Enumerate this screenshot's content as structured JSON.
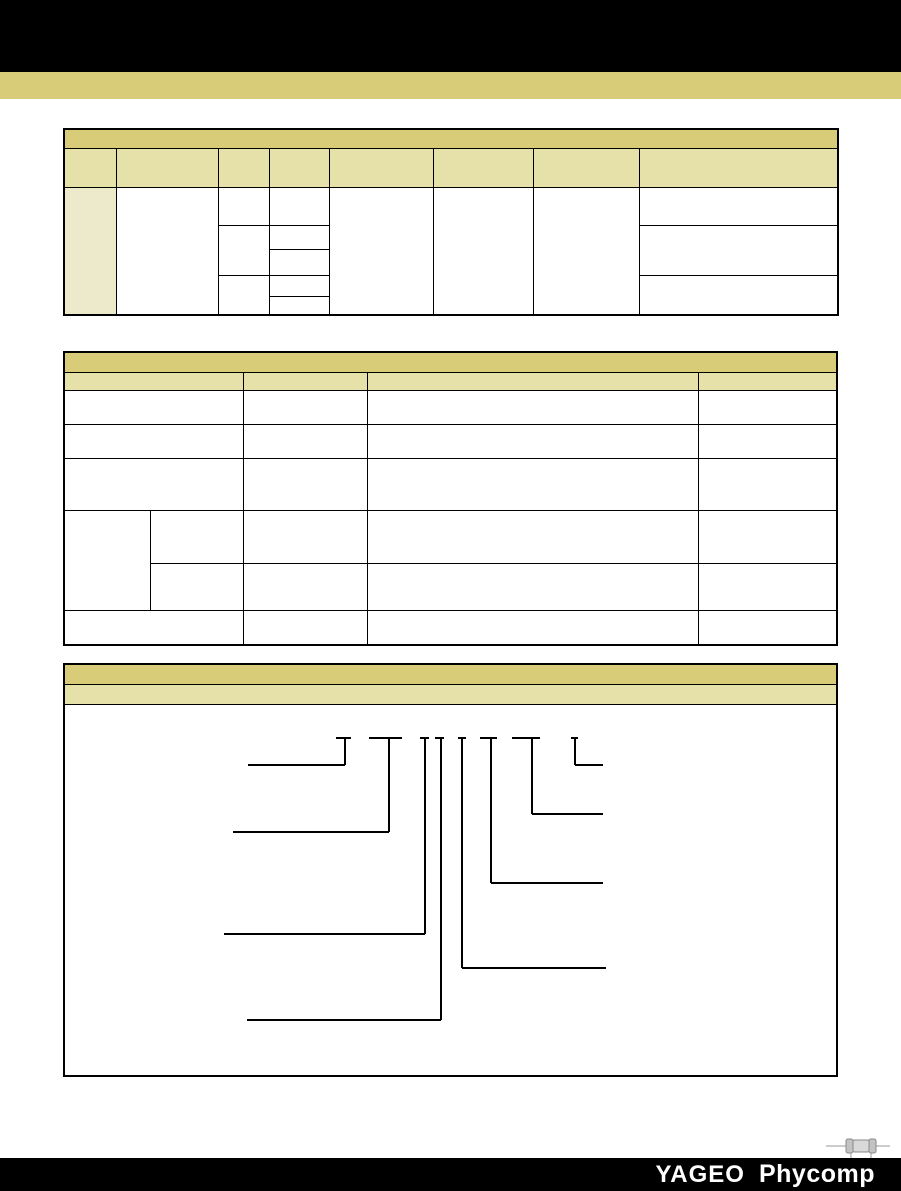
{
  "colors": {
    "black_band": "#000000",
    "khaki_band": "#d8cc79",
    "title_bar_bg": "#d8cc79",
    "header_row_bg": "#e6e0a9",
    "shaded_cell_bg": "#ede9cb",
    "table_border": "#000000",
    "diagram_line": "#000000",
    "footer_bg": "#000000",
    "footer_text": "#ffffff",
    "icon_gray": "#999999"
  },
  "sections": {
    "table1": {
      "title_text": ""
    },
    "table2": {
      "title_text": ""
    },
    "ordering": {
      "title_text": "",
      "subtitle_text": ""
    }
  },
  "footer": {
    "brand_primary": "YAGEO",
    "brand_secondary": "Phycomp"
  },
  "diagram": {
    "stems": [
      {
        "x": 282,
        "tick": [
          273,
          288
        ],
        "top": 33,
        "drop": 60,
        "lead": 185,
        "side": "left"
      },
      {
        "x": 326,
        "tick": [
          306,
          339
        ],
        "top": 33,
        "drop": 127,
        "lead": 170,
        "side": "left"
      },
      {
        "x": 362,
        "tick": [
          357,
          366
        ],
        "top": 33,
        "drop": 229,
        "lead": 161,
        "side": "left"
      },
      {
        "x": 378,
        "tick": [
          372,
          381
        ],
        "top": 33,
        "drop": 315,
        "lead": 184,
        "side": "left"
      },
      {
        "x": 399,
        "tick": [
          395,
          403
        ],
        "top": 33,
        "drop": 263,
        "lead": 543,
        "side": "right"
      },
      {
        "x": 428,
        "tick": [
          417,
          434
        ],
        "top": 33,
        "drop": 178,
        "lead": 540,
        "side": "right"
      },
      {
        "x": 469,
        "tick": [
          449,
          477
        ],
        "top": 33,
        "drop": 109,
        "lead": 540,
        "side": "right"
      },
      {
        "x": 512,
        "tick": [
          508,
          515
        ],
        "top": 33,
        "drop": 60,
        "lead": 540,
        "side": "right"
      }
    ]
  }
}
